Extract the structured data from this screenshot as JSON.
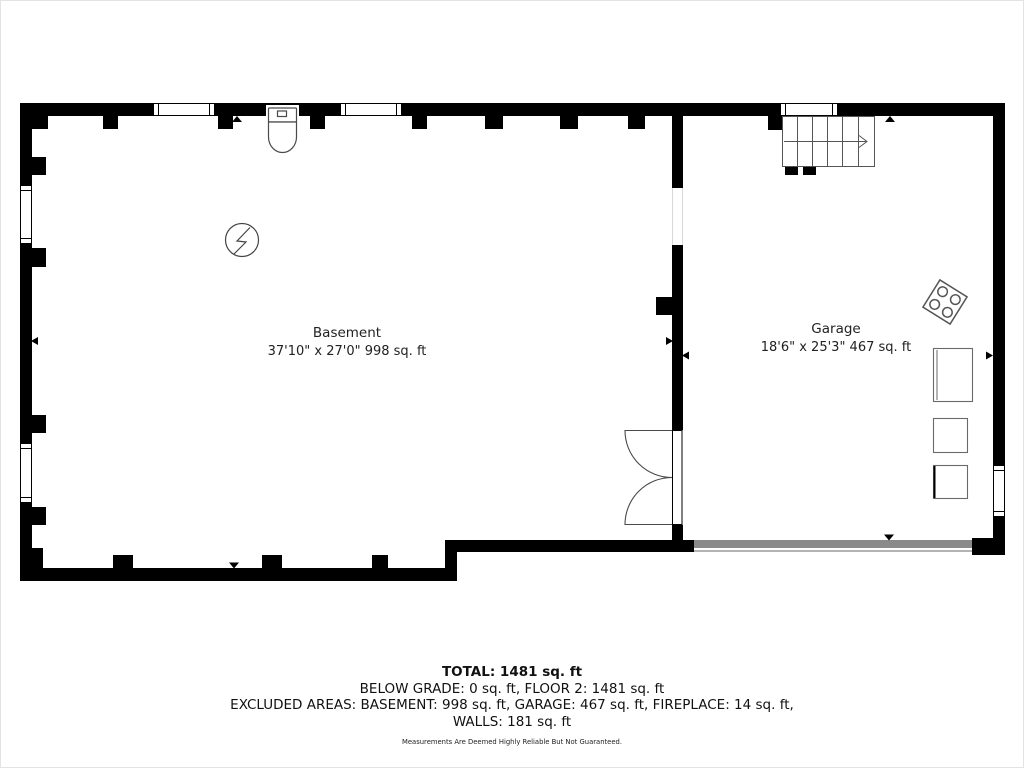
{
  "floorplan": {
    "rooms": [
      {
        "name": "Basement",
        "dimensions": "37'10\" x 27'0\" 998 sq. ft"
      },
      {
        "name": "Garage",
        "dimensions": "18'6\" x 25'3\" 467 sq. ft"
      }
    ],
    "fixtures": [
      "toilet-icon",
      "electrical-panel-icon",
      "stairs-icon",
      "double-door-icon",
      "cooktop-icon",
      "appliance",
      "garage-door",
      "window"
    ],
    "colors": {
      "wall": "#000000",
      "garage_door": "#8a8a8a",
      "fixture_stroke": "#4a4a4a",
      "background": "#ffffff"
    }
  },
  "summary": {
    "total": "TOTAL: 1481 sq. ft",
    "below_grade_floor2": "BELOW GRADE: 0 sq. ft, FLOOR 2: 1481 sq. ft",
    "excluded_areas": "EXCLUDED AREAS: BASEMENT: 998 sq. ft, GARAGE: 467 sq. ft, FIREPLACE: 14 sq. ft,",
    "walls": "WALLS: 181 sq. ft",
    "disclaimer": "Measurements Are Deemed Highly Reliable But Not Guaranteed."
  }
}
